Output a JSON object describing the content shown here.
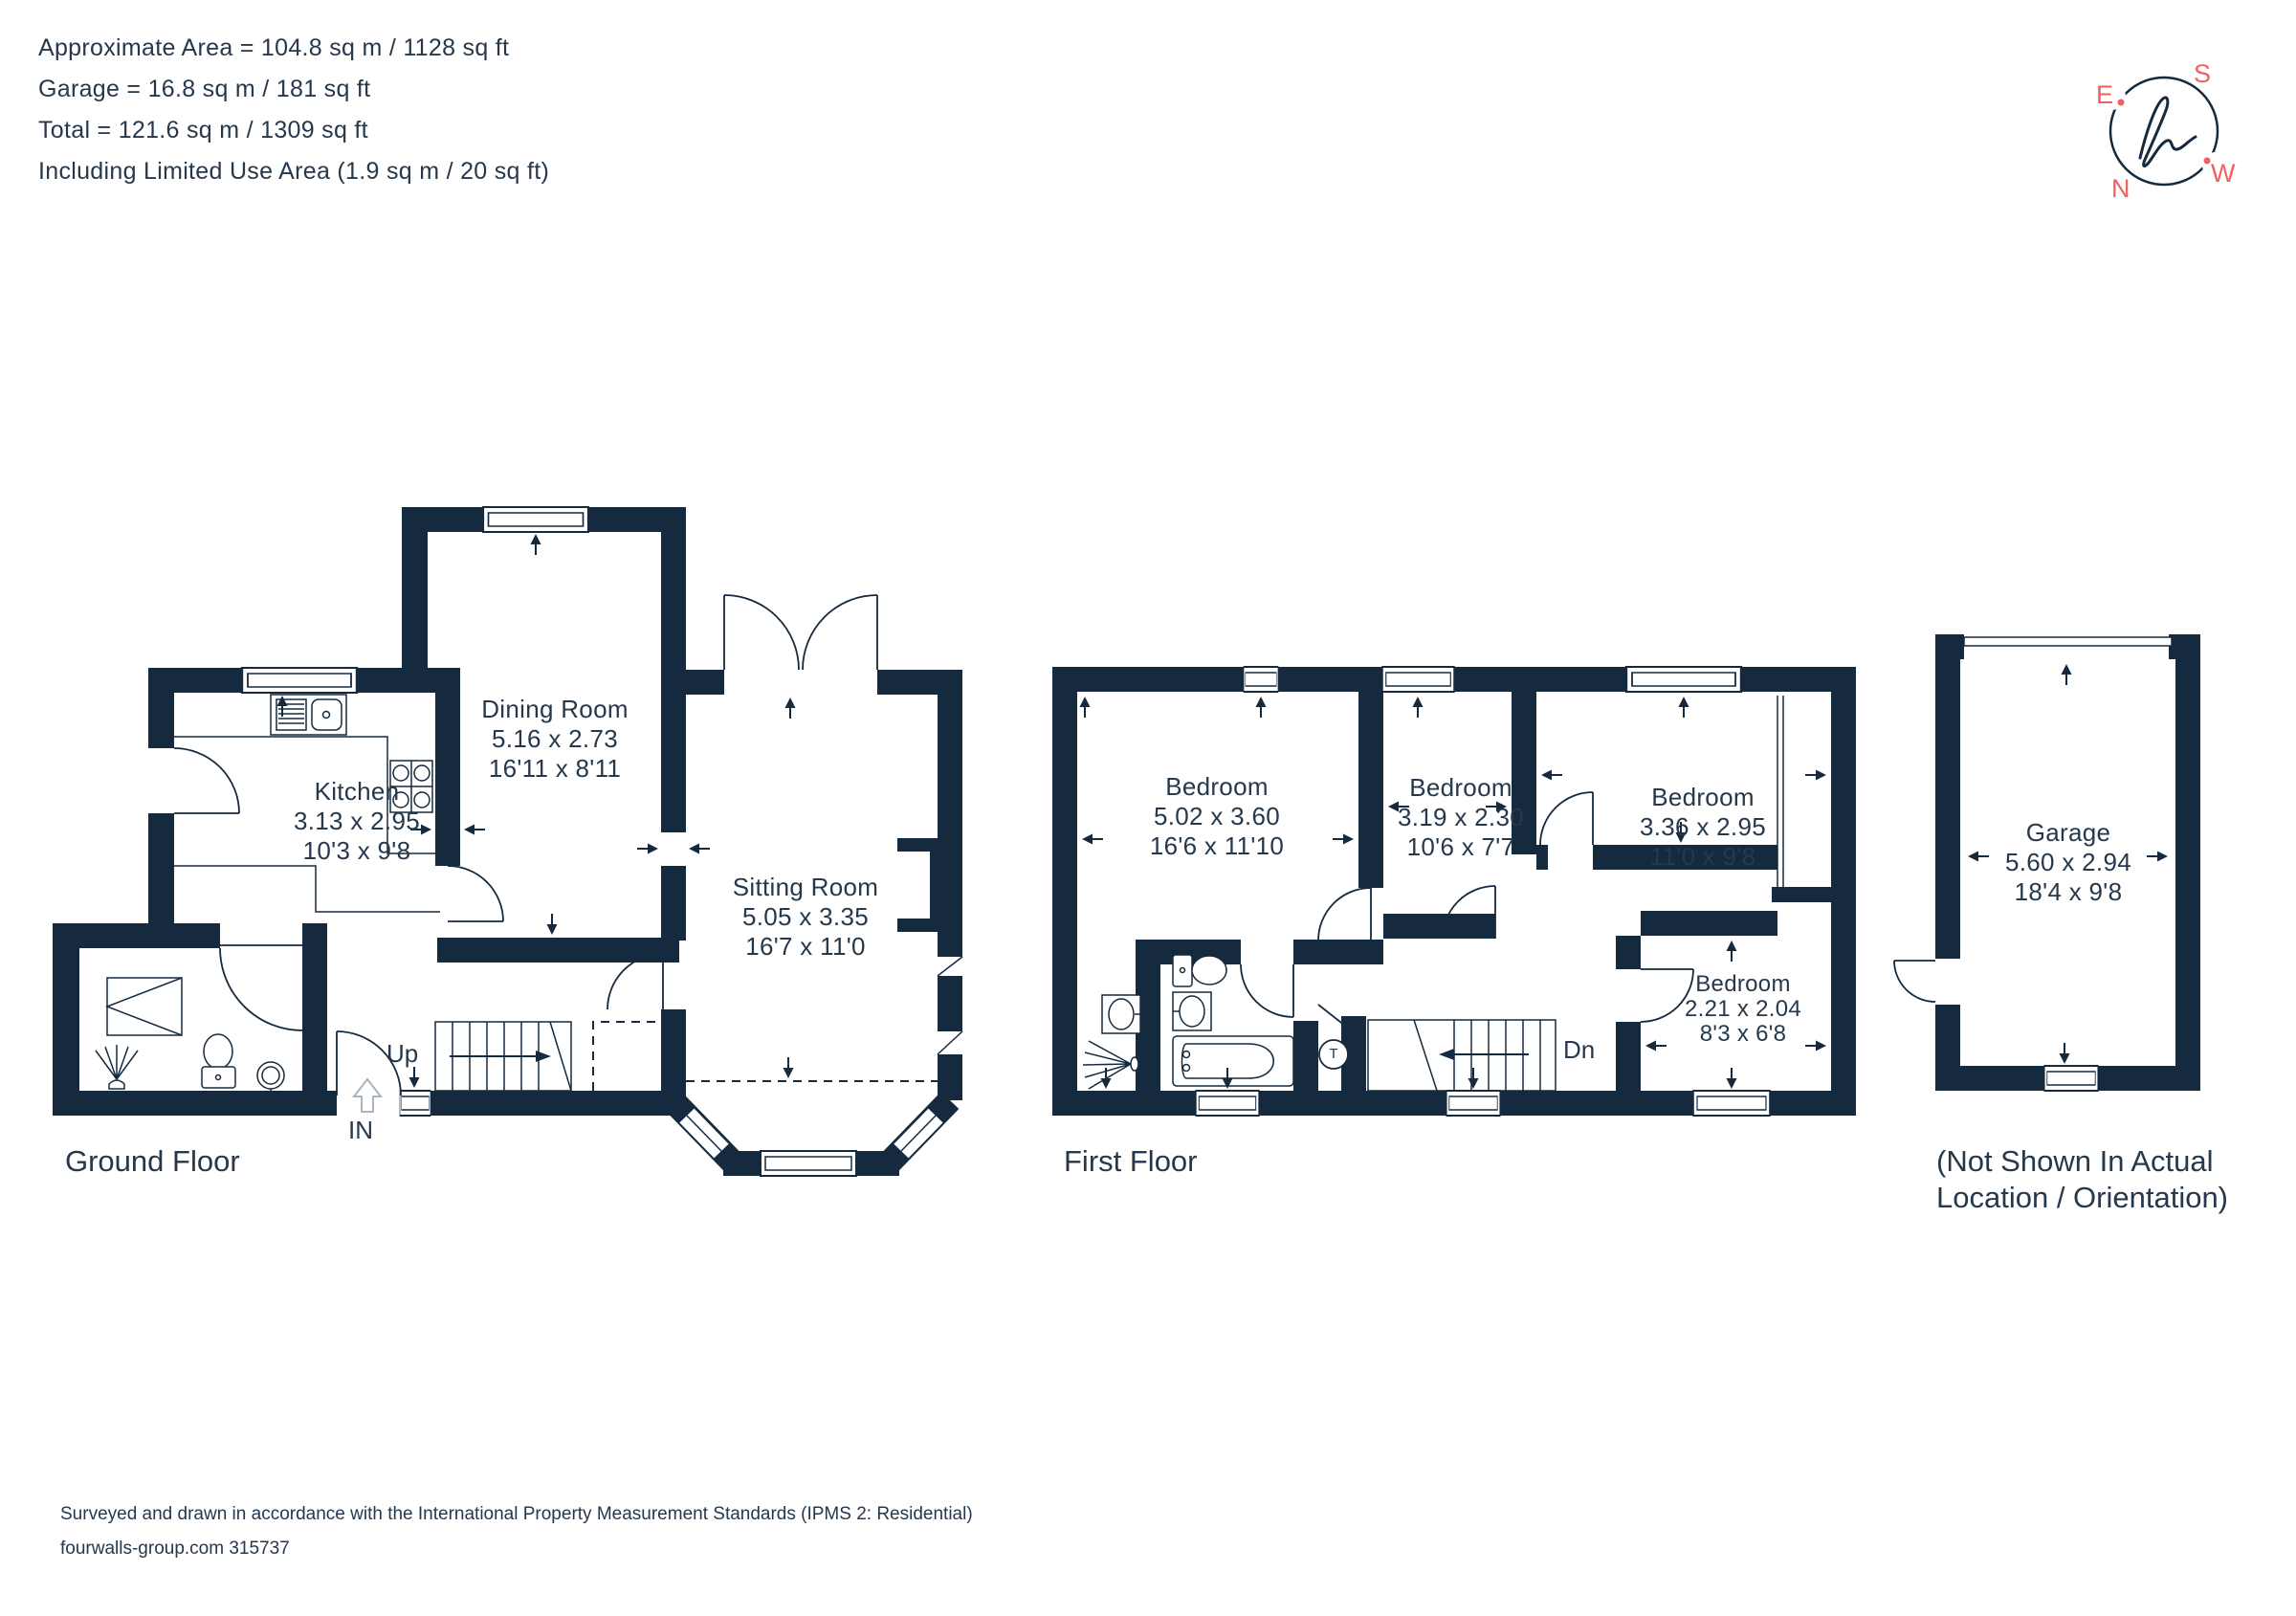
{
  "header": {
    "area_lines": [
      "Approximate Area = 104.8 sq m / 1128 sq ft",
      "Garage = 16.8 sq m / 181 sq ft",
      "Total = 121.6 sq m / 1309 sq ft",
      "Including Limited Use Area (1.9 sq m / 20 sq ft)"
    ]
  },
  "compass": {
    "north": "N",
    "east": "E",
    "south": "S",
    "west": "W"
  },
  "floors": {
    "ground": {
      "label": "Ground Floor"
    },
    "first": {
      "label": "First Floor"
    },
    "garage_note_line1": "(Not Shown In Actual",
    "garage_note_line2": "Location / Orientation)"
  },
  "rooms": {
    "dining": {
      "name": "Dining Room",
      "metric": "5.16 x 2.73",
      "imperial": "16'11 x 8'11"
    },
    "kitchen": {
      "name": "Kitchen",
      "metric": "3.13 x 2.95",
      "imperial": "10'3 x 9'8"
    },
    "sitting": {
      "name": "Sitting Room",
      "metric": "5.05 x 3.35",
      "imperial": "16'7 x 11'0"
    },
    "bed1": {
      "name": "Bedroom",
      "metric": "5.02 x 3.60",
      "imperial": "16'6 x 11'10"
    },
    "bed2": {
      "name": "Bedroom",
      "metric": "3.19 x 2.30",
      "imperial": "10'6 x 7'7"
    },
    "bed3": {
      "name": "Bedroom",
      "metric": "3.36 x 2.95",
      "imperial": "11'0 x 9'8"
    },
    "bed4": {
      "name": "Bedroom",
      "metric": "2.21 x 2.04",
      "imperial": "8'3 x 6'8"
    },
    "garage": {
      "name": "Garage",
      "metric": "5.60 x 2.94",
      "imperial": "18'4 x 9'8"
    }
  },
  "annotations": {
    "up": "Up",
    "down": "Dn",
    "entrance": "IN",
    "tank": "T"
  },
  "footer": {
    "line1": "Surveyed and drawn in accordance with the International Property Measurement Standards (IPMS 2: Residential)",
    "line2": "fourwalls-group.com 315737"
  },
  "colors": {
    "wall": "#152A3E",
    "text": "#26384C",
    "accent": "#F0605E"
  }
}
